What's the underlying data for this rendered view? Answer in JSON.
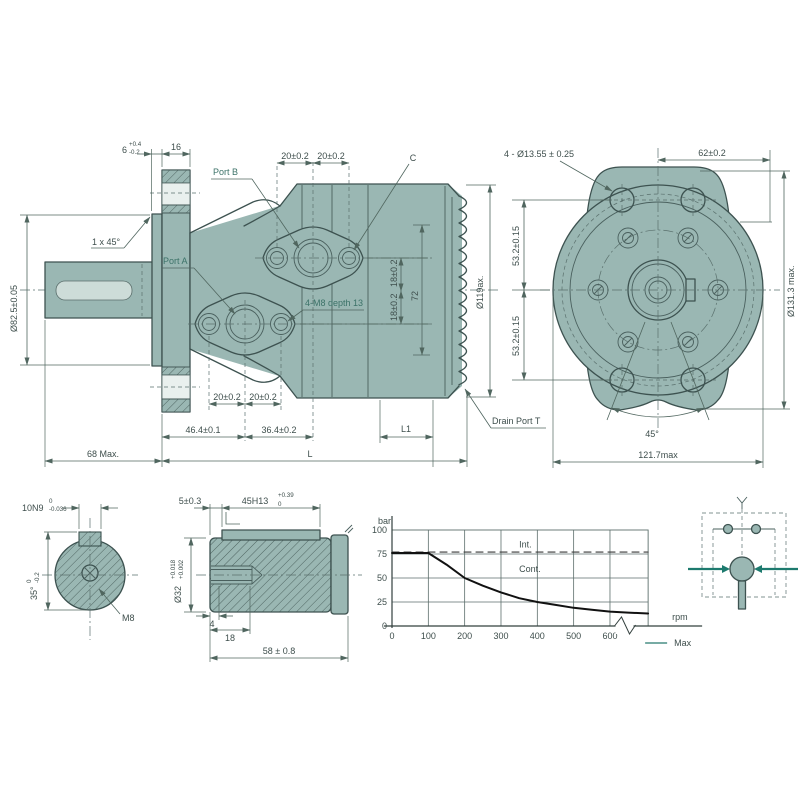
{
  "colors": {
    "body_fill": "#9ab7b3",
    "outline": "#3d5250",
    "dimension": "#50665f",
    "accent_teal": "#1d7a6e",
    "curve": "#111111"
  },
  "side": {
    "d6": "6",
    "d6_tp": "+0.4",
    "d6_tm": "-0.2",
    "d16": "16",
    "d20_top_a": "20±0.2",
    "d20_top_b": "20±0.2",
    "c_label": "C",
    "port_b": "Port B",
    "port_a": "Port A",
    "chamfer": "1 x 45°",
    "shaft_dia": "Ø82.5±0.05",
    "m8_depth": "4-M8 depth 13",
    "d18_a": "18±0.2",
    "d18_b": "18±0.2",
    "d72": "72",
    "d119": "Ø119ax.",
    "d20_bot_a": "20±0.2",
    "d20_bot_b": "20±0.2",
    "d46_4": "46.4±0.1",
    "d36_4": "36.4±0.2",
    "l1": "L1",
    "drain": "Drain Port T",
    "d68": "68 Max.",
    "l": "L"
  },
  "front": {
    "holes": "4 - Ø13.55 ± 0.25",
    "d62": "62±0.2",
    "d53_a": "53.2±0.15",
    "d53_b": "53.2±0.15",
    "d131_3": "Ø131.3 max.",
    "a45": "45°",
    "d121_7": "121.7max"
  },
  "key_view": {
    "d10n9": "10N9",
    "t10_top": "0",
    "t10_bot": "-0.036",
    "d35": "35°",
    "t35_top": "0",
    "t35_bot": "-0.2",
    "m8": "M8"
  },
  "shaft_view": {
    "d5": "5±0.3",
    "d45h13": "45H13",
    "t45_top": "+0.39",
    "t45_bot": "0",
    "d32": "Ø32",
    "t32_top": "+0.018",
    "t32_bot": "+0.002",
    "d4": "4",
    "d18": "18",
    "d58": "58 ± 0.8"
  },
  "chart_data": {
    "type": "line",
    "title": "",
    "ylabel": "bar",
    "xlabel": "rpm",
    "x_ticks": [
      0,
      100,
      200,
      300,
      400,
      500,
      600
    ],
    "y_ticks": [
      0,
      25,
      50,
      75,
      100
    ],
    "xlim": [
      0,
      705
    ],
    "ylim": [
      0,
      100
    ],
    "grid": true,
    "axis_break_x": 640,
    "series": [
      {
        "name": "Int.",
        "style": "dashed",
        "color": "#3a3a3a",
        "points": [
          [
            0,
            77
          ],
          [
            705,
            77
          ]
        ]
      },
      {
        "name": "Cont.",
        "style": "solid",
        "color": "#111111",
        "points": [
          [
            0,
            76
          ],
          [
            100,
            76
          ],
          [
            150,
            64
          ],
          [
            200,
            50
          ],
          [
            250,
            42
          ],
          [
            300,
            35
          ],
          [
            350,
            29
          ],
          [
            400,
            25
          ],
          [
            450,
            22
          ],
          [
            500,
            19
          ],
          [
            550,
            17
          ],
          [
            600,
            15
          ],
          [
            650,
            14
          ],
          [
            705,
            13
          ]
        ]
      }
    ],
    "annotations": [
      {
        "text": "Int.",
        "x": 350,
        "y": 82
      },
      {
        "text": "Cont.",
        "x": 350,
        "y": 56
      }
    ],
    "legend": [
      {
        "label": "Max",
        "color": "#4a8f85"
      }
    ],
    "legend_position": "bottom-right"
  }
}
